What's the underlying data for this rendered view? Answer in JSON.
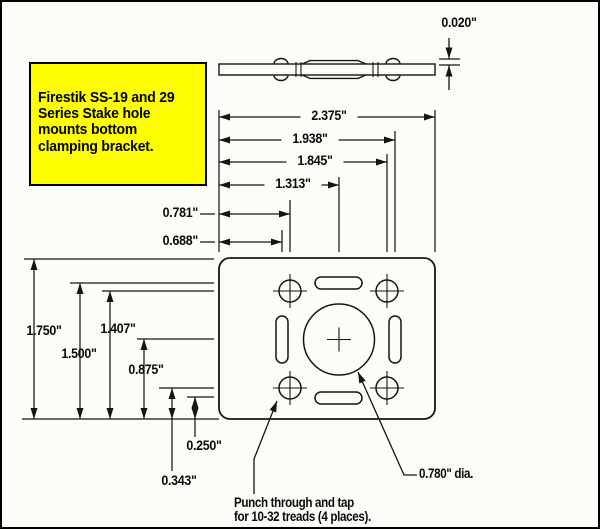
{
  "note_box": {
    "text": "Firestik SS-19 and 29\nSeries Stake hole\nmounts bottom\nclamping bracket."
  },
  "dims": {
    "thickness": "0.020\"",
    "overall_width": "2.375\"",
    "right_slot_x": "1.938\"",
    "right_holes_x": "1.845\"",
    "center_hole_x": "1.313\"",
    "left_holes_x": "0.781\"",
    "left_slot_x": "0.688\"",
    "overall_height": "1.750\"",
    "top_slot_y": "1.500\"",
    "top_holes_y": "1.407\"",
    "center_hole_y": "0.875\"",
    "bottom_slot_y": "0.250\"",
    "bottom_holes_y": "0.343\""
  },
  "annotations": {
    "center_hole_diameter": "0.780\" dia.",
    "punch_note": "Punch through and tap\nfor 10-32 treads (4 places)."
  },
  "colors": {
    "line": "#151515",
    "note_bg": "#ffff00",
    "background": "#fcfcf9"
  }
}
